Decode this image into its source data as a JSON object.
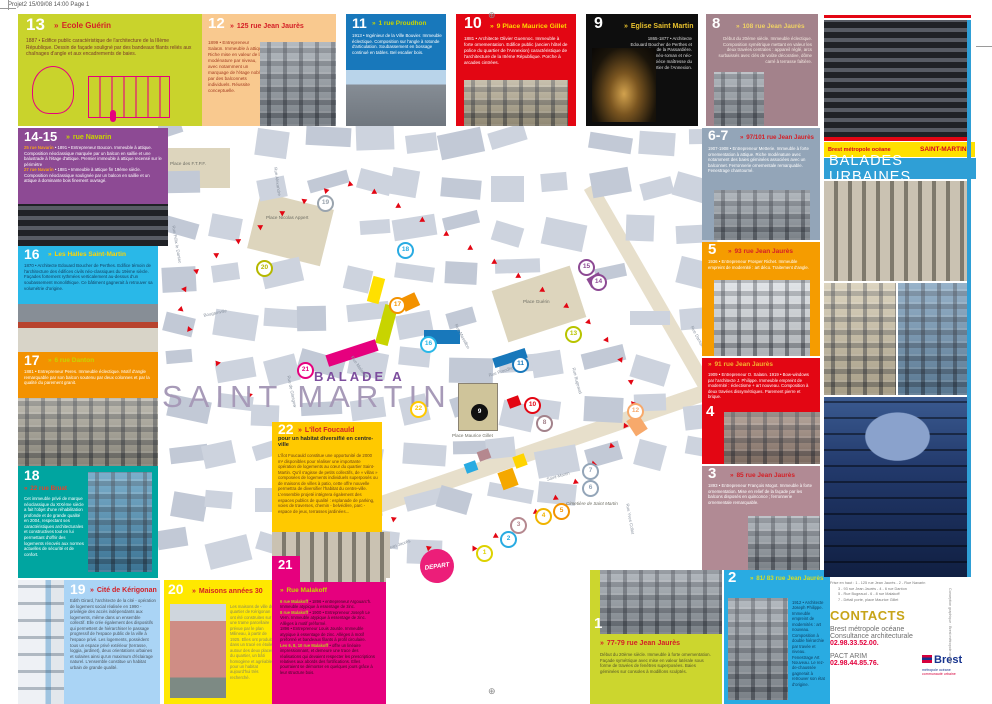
{
  "page": {
    "print_header": "Projet2  15/09/08  14:00  Page 1"
  },
  "icons": {
    "marker": "»",
    "registration": "⊕"
  },
  "palette": {
    "accent_blue": "#2f9fd6",
    "accent_yellow": "#ffe000",
    "accent_red": "#e30613",
    "accent_pink": "#e6007e"
  },
  "brand": {
    "agency": "Brest métropole océane",
    "quarter": "SAINT-MARTIN",
    "series": "BALADES URBAINES"
  },
  "tiles": {
    "t13": {
      "num": "13",
      "title": "Ecole Guérin",
      "body": "1887 • Edifice public caractéristique de l'architecture de la IIIème République. Dessin de façade souligné par des bandeaux filants reliés aux chaînages d'angle et aux encadrements de baies."
    },
    "t12": {
      "num": "12",
      "title": "125 rue Jean Jaurès",
      "body": "1899 • Entrepreneur Salaün. Immeuble à attique. Riche mise en valeur de la modénature par niveau, avec notamment un marquage de l'étage noble par des balconnets individuels. Réussite conceptuelle."
    },
    "t11": {
      "num": "11",
      "title": "1 rue Proudhon",
      "body": "1913 • Ingénieur de la Ville Bouvier. Immeuble éclectique. Composition sur l'angle à rotonde d'articulation. Soubassement en bossage continué en tables. Bel escalier bois."
    },
    "t10": {
      "num": "10",
      "title": "9 Place Maurice Gillet",
      "body": "1881 • Architecte Olivier Guennoc. Immeuble à forte ornementation. Edifice public (ancien hôtel de police du quartier de l'Annexion) caractéristique de l'architecture de la IIIème République. Porche à arcades cintrées."
    },
    "t9": {
      "num": "9",
      "title": "Eglise Saint Martin",
      "body": "1865-1877 • Architecte Edouard Boucher de Perthes et Jourdan de la Passardière. Edifice néo-roman et néo-gothique, pièce maîtresse du quartier de l'Annexion."
    },
    "t8": {
      "num": "8",
      "title": "108 rue Jean Jaurès",
      "body": "Début du 20ème siècle. Immeuble éclectique. Composition symétrique mettant en valeur les deux travées centrales : appareil réglé, arcs surbaissés avec clés de voûte décorative, dôme carré à terrasse faîtière."
    },
    "t67": {
      "num": "6-7",
      "title": "97/101 rue Jean Jaurès",
      "body": "1907-1908 • Entrepreneur Metterie. Immeuble à forte ornementation à attique. Riche modénature avec notamment des baies géminées associées avec un balconnet. Ferronnerie ornementale remarquable. Fenestrage chantourné."
    },
    "t5": {
      "num": "5",
      "title": "93 rue Jean Jaurès",
      "body": "1936 • Entrepreneur Prosper Richet. Immeuble empreint de modernité : art déco. Traitement d'angle."
    },
    "t4": {
      "num": "4",
      "title": "91 rue Jean Jaurès",
      "body": "1909 • Entrepreneur O. Salaün. 1919 • Bow-windows par l'architecte J. Philippe. Immeuble empreint de modernité : éclectisme + art nouveau. Composition à deux travées dissymétriques. Parement pierre et brique."
    },
    "t3": {
      "num": "3",
      "title": "85 rue Jean Jaurès",
      "body": "1893 • Entrepreneur François Mogot. Immeuble à forte ornementation. Mise en relief de la façade par les balcons disposés en quinconce ; ferronnerie ornementale remarquable."
    },
    "t2": {
      "num": "2",
      "title": "81/ 83 rue Jean Jaurès",
      "body": "1912 • Architecte Joseph Philippe. Immeuble empreint de modernités : art nouveau. Composition à double hiérarchie par travée et niveau. Fenestrage Art Nouveau. Le rez-de-chaussée gagnerait à retrouver son état d'origine."
    },
    "t1": {
      "num": "1",
      "title": "77-79 rue Jean Jaurès",
      "body": "Début du 20ème siècle. Immeuble à forte ornementation. Façade symétrique avec mise en valeur latérale sous forme de travées de fenêtres superposées. Baies géminées sur consoles à modillons sculptés."
    },
    "t1415": {
      "num": "14-15",
      "title": "rue Navarin",
      "addr1": "25 rue Navarin",
      "body1": "• 1891 • Entrepreneur Boucon. Immeuble à attique. Composition néoclassique marquée par un balcon en saillie et une balustrade à l'étage d'attique. Premier immeuble à attique recensé sur le périmètre",
      "addr2": "27 rue Navarin",
      "body2": "• 1881 • Immeuble à attique fin 19ème siècle. Composition néoclassique soulignée par un balcon en saillie et un attique à dominante bois finement ouvragé."
    },
    "t16": {
      "num": "16",
      "title": "Les Halles Saint-Martin",
      "body": "1870 • Architecte Edouard Boucher de Perthes. Edifice témoin de l'architecture des édifices civils néo-classiques du 19ème siècle. Façades fortement rythmées verticalement au-dessus d'un soubassement monolithique. Ce bâtiment gagnerait à retrouver sa volumétrie d'origine."
    },
    "t17": {
      "num": "17",
      "title": "6 rue Danton",
      "body": "1881 • Entrepreneur Peres. Immeuble éclectique. Motif d'angle remarquable par son balcon soutenu par deux colonnes et par la qualité du parement granit."
    },
    "t18": {
      "num": "18",
      "title": "22 rue Bruat",
      "body": "Cet immeuble privé de marque néoclassique du XIXème siècle a fait l'objet d'une réhabilitation profonde et de grande qualité en 2004, respectant ses caractéristiques architecturales et constructives tout en lui permettant d'offrir des logements rénovés aux normes actuelles de sécurité et de confort."
    },
    "t19": {
      "num": "19",
      "title": "Cité de Kérigonan",
      "body": "Edith Girard, l'architecte de la cité - opération de logement social réalisée en 1990 - privilégie des accès indépendants aux logements, même dans un ensemble collectif. Elle crée également des dispositifs qui permettent de hiérarchiser le passage progressif de l'espace public de la ville à l'espace privé. Les logements, possèdent tous un espace privé extérieur (terrasse, loggia, jardinet), deux orientations urbaines et solaires ainsi qu'un maximum d'éclairage naturel. L'ensemble constitue un habitat urbain de grande qualité."
    },
    "t20": {
      "num": "20",
      "title": "Maisons années 30",
      "body": "Les maisons de ville du quartier de Kérigonan ont été construites sur une trame parcellaire prévue par le plan Milineau, à partir de 1925. Elles ont produit, dans un tracé en étoiles autour des deux places du quartier, un bâti homogène et agréable, pour un habitat aujourd'hui très recherché."
    },
    "t21": {
      "num": "21",
      "title": "Rue Malakoff",
      "addr1": "6 rue Malakoff",
      "body1": "• 1896 • entrepreneur Argouarc'h. Immeuble atypique à essentage de zinc.",
      "addr2": "8 rue Malakoff",
      "body2": "• 1900 • Entrepreneur Joseph Le Vern. Immeuble atypique à essentage de zinc. Allèges à motif préformé.",
      "body3": "1896 • Entrepreneur Louis Jourde. Immeuble atypique à essentage de zinc. Allèges à motif préformé et bandeaux filants à profil circulaire.",
      "addr3": "Les 6, 8, 10 rue Malakoff",
      "body4": "• offre un linéaire impressionnant, et demeure une trace des réalisations qui devaient respecter les prescriptions relatives aux abords des fortifications. Elles pourraient se démonter en quelques jours grâce à leur structure bois."
    },
    "t22": {
      "num": "22",
      "title": "L'îlot Foucauld",
      "subtitle": "pour un habitat diversifié en centre-ville",
      "body": "L'îlot Foucauld constitue une opportunité de 2000 m² disponibles pour réaliser une importante opération de logements au cœur du quartier Saint-Martin. Qu'il s'agisse de petits collectifs, de « villas » composées de logements individuels superposés ou de maisons de villes à patio, cette offre nouvelle permettra de diversifier l'habitat du centre-ville. L'ensemble projeté intégrera également des espaces publics de qualité : esplanade de parking, voies de traverses, chemin - belvédère, parc - espace de jeux, terrasses jardinées..."
    }
  },
  "map": {
    "balade": "BALADE A",
    "district": "SAINT MARTIN",
    "depart": "DEPART",
    "places": [
      {
        "label": "Place des F.T.P.F.",
        "x": 12,
        "y": 36,
        "w": 60
      },
      {
        "label": "Place Nicolas Appert",
        "x": 108,
        "y": 90,
        "w": 50
      },
      {
        "label": "Place Guérin",
        "x": 365,
        "y": 174,
        "w": 60
      },
      {
        "label": "Place Maurice Gillet",
        "x": 294,
        "y": 308,
        "w": 44
      },
      {
        "label": "Cimetière de Saint Martin",
        "x": 408,
        "y": 376,
        "w": 58,
        "italic": true
      }
    ],
    "streets": [
      {
        "t": "Rue Jean Jaurès",
        "x": 220,
        "y": 424,
        "r": -19
      },
      {
        "t": "Rue Danton",
        "x": 536,
        "y": 200,
        "r": 62
      },
      {
        "t": "Rue de Glasgow",
        "x": 133,
        "y": 250,
        "r": 78
      },
      {
        "t": "Bougainville",
        "x": 45,
        "y": 188,
        "r": -12
      },
      {
        "t": "Rue Félix le Dantec",
        "x": 18,
        "y": 100,
        "r": 80
      },
      {
        "t": "Rue Massillon",
        "x": 300,
        "y": 198,
        "r": 62
      },
      {
        "t": "Rue Bugeaud",
        "x": 418,
        "y": 242,
        "r": 75
      },
      {
        "t": "Rue Proudhon",
        "x": 330,
        "y": 248,
        "r": -18
      },
      {
        "t": "Saint-Martin",
        "x": 388,
        "y": 352,
        "r": -16
      },
      {
        "t": "Rue Yves Collet",
        "x": 472,
        "y": 378,
        "r": 80
      },
      {
        "t": "Rue Malakoff",
        "x": 196,
        "y": 230,
        "r": 55
      },
      {
        "t": "Rue Alexandre",
        "x": 120,
        "y": 42,
        "r": 82
      }
    ],
    "markers": [
      {
        "n": "1",
        "x": 325,
        "y": 427,
        "c": "#ddd200"
      },
      {
        "n": "2",
        "x": 349,
        "y": 413,
        "c": "#29abe2"
      },
      {
        "n": "3",
        "x": 359,
        "y": 399,
        "c": "#b5888f"
      },
      {
        "n": "4",
        "x": 384,
        "y": 390,
        "c": "#f0b400"
      },
      {
        "n": "5",
        "x": 402,
        "y": 385,
        "c": "#f39200"
      },
      {
        "n": "6",
        "x": 431,
        "y": 362,
        "c": "#93a5b8"
      },
      {
        "n": "7",
        "x": 431,
        "y": 345,
        "c": "#93a5b8"
      },
      {
        "n": "8",
        "x": 385,
        "y": 297,
        "c": "#a3828b"
      },
      {
        "n": "9",
        "x": 320,
        "y": 286,
        "c": "#111111",
        "f": true
      },
      {
        "n": "10",
        "x": 373,
        "y": 279,
        "c": "#e30613"
      },
      {
        "n": "11",
        "x": 361,
        "y": 238,
        "c": "#1878bb"
      },
      {
        "n": "12",
        "x": 476,
        "y": 285,
        "c": "#f7a96b"
      },
      {
        "n": "13",
        "x": 414,
        "y": 208,
        "c": "#b8c400"
      },
      {
        "n": "14",
        "x": 439,
        "y": 156,
        "c": "#8d4a94"
      },
      {
        "n": "15",
        "x": 427,
        "y": 141,
        "c": "#8d4a94"
      },
      {
        "n": "16",
        "x": 269,
        "y": 218,
        "c": "#29b8e8"
      },
      {
        "n": "17",
        "x": 238,
        "y": 179,
        "c": "#f39200"
      },
      {
        "n": "18",
        "x": 246,
        "y": 124,
        "c": "#29abe2"
      },
      {
        "n": "19",
        "x": 166,
        "y": 77,
        "c": "#9aa4ae"
      },
      {
        "n": "20",
        "x": 105,
        "y": 142,
        "c": "#b5b800"
      },
      {
        "n": "21",
        "x": 146,
        "y": 244,
        "c": "#e6007e"
      },
      {
        "n": "22",
        "x": 259,
        "y": 283,
        "c": "#ffc900"
      }
    ]
  },
  "contacts": {
    "heading": "CONTACTS",
    "org": "Brest métropole océane",
    "service": "Consultance architecturale",
    "phone": "02.98.33.52.00.",
    "org2": "PACT ARIM",
    "phone2": "02.98.44.85.76."
  },
  "credits": {
    "line1": "Frise en haut : 1 - 125 rue Jean Jaurès - 2 - Rue Navarin",
    "line2": "3 - 93 rue Jean Jaurès - 4 - 6 rue Danton",
    "line3": "5 - Rue Bugeaud - 6 - 8 rue Malakoff",
    "line4": "7 - Détail porte, place Maurice Gillet",
    "side": "Conception graphique : Brest métropole océane"
  },
  "logo": {
    "name": "Brest",
    "sub1": "métropole océane",
    "sub2": "communauté urbaine"
  }
}
